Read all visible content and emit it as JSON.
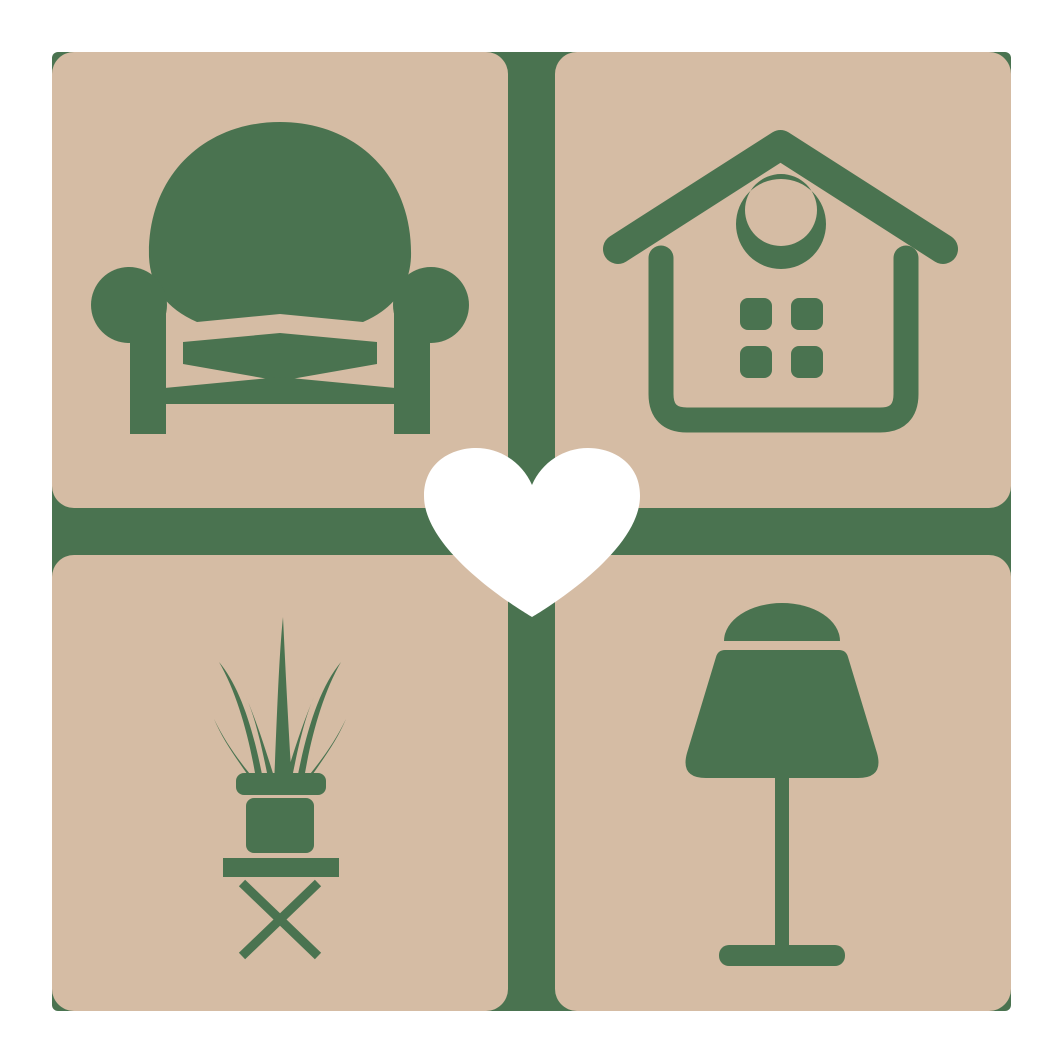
{
  "logo": {
    "description": "Furniture and home decor logo: four rounded beige tiles arranged in a 2x2 grid over a green cross background, a white heart at the center",
    "colors": {
      "canvas": "#ffffff",
      "tile": "#d5bca4",
      "icon": "#4a7350",
      "heart": "#ffffff"
    },
    "tiles": [
      {
        "position": "top-left",
        "icon": "armchair-icon"
      },
      {
        "position": "top-right",
        "icon": "house-icon"
      },
      {
        "position": "bottom-left",
        "icon": "potted-plant-icon"
      },
      {
        "position": "bottom-right",
        "icon": "table-lamp-icon"
      }
    ],
    "center": {
      "icon": "heart-icon"
    }
  }
}
